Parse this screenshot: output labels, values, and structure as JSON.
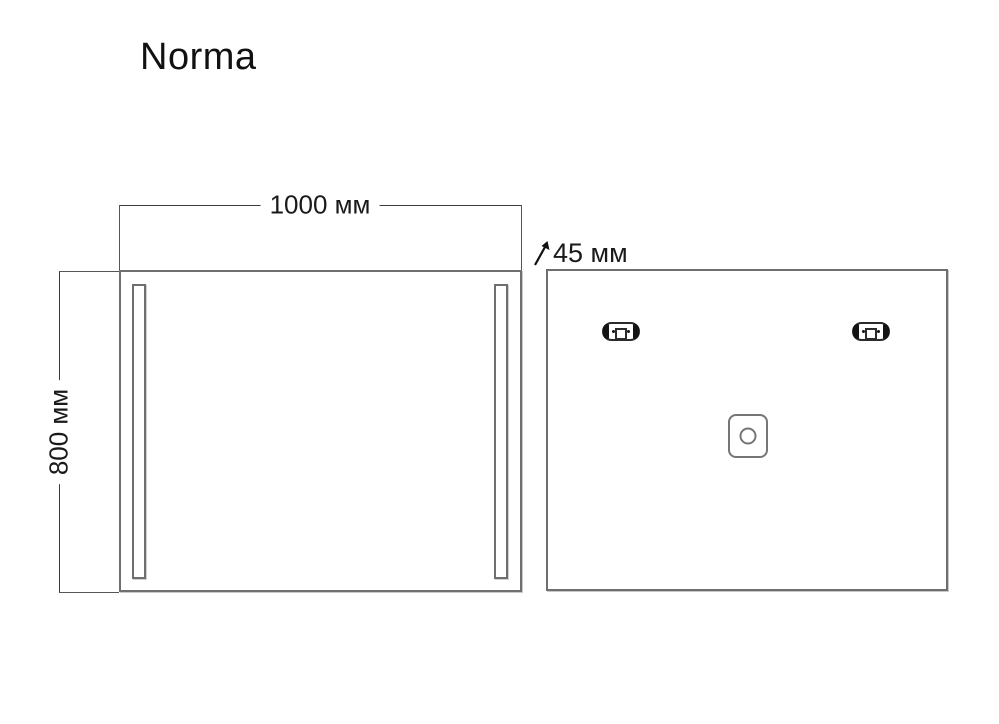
{
  "title": "Norma",
  "front_view": {
    "name": "mirror front view with two vertical LED strips",
    "width_label": "1000 мм",
    "height_label": "800 мм"
  },
  "depth": {
    "label": "45 мм"
  },
  "back_view": {
    "name": "mirror back view with two mounting brackets and junction box"
  },
  "colors": {
    "background": "#ffffff",
    "outline": "#6f6f6f",
    "dimension_line": "#3c3c3c",
    "bracket": "#2b2b2b",
    "text": "#1a1a1a"
  }
}
